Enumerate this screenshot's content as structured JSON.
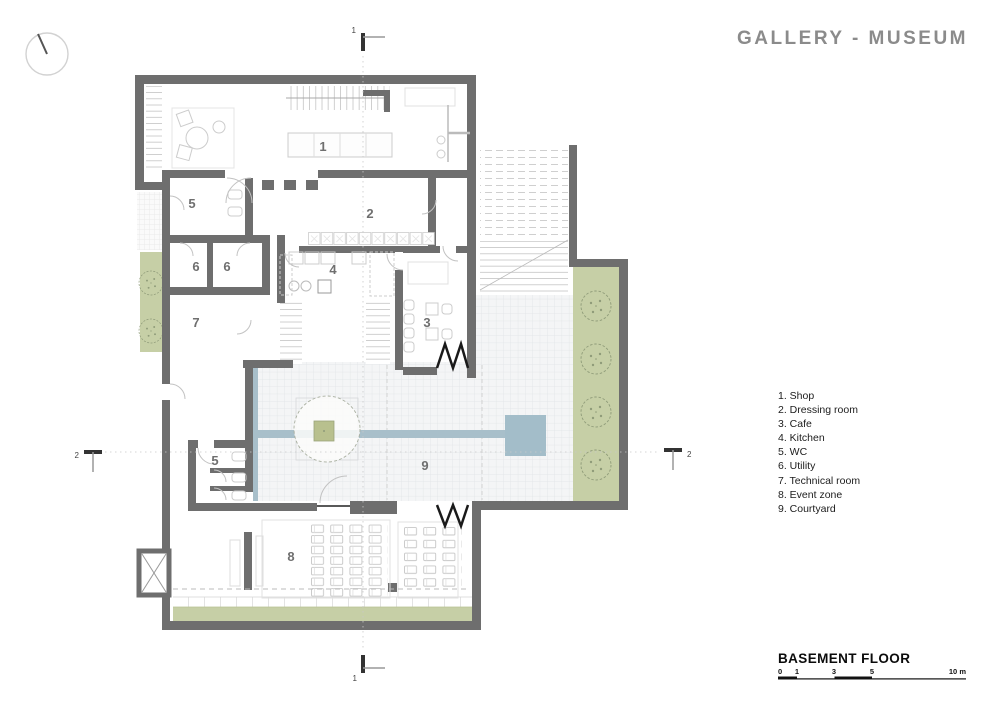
{
  "title": "GALLERY - MUSEUM",
  "floor": {
    "label": "BASEMENT FLOOR"
  },
  "legend": {
    "items": [
      "1. Shop",
      "2. Dressing room",
      "3. Cafe",
      "4. Kitchen",
      "5. WC",
      "6. Utility",
      "7. Technical room",
      "8. Event zone",
      "9. Courtyard"
    ]
  },
  "rooms": [
    {
      "num": "1",
      "name": "Shop"
    },
    {
      "num": "2",
      "name": "Dressing room"
    },
    {
      "num": "3",
      "name": "Cafe"
    },
    {
      "num": "4",
      "name": "Kitchen"
    },
    {
      "num": "5",
      "name": "WC"
    },
    {
      "num": "6",
      "name": "Utility"
    },
    {
      "num": "7",
      "name": "Technical room"
    },
    {
      "num": "8",
      "name": "Event zone"
    },
    {
      "num": "9",
      "name": "Courtyard"
    }
  ],
  "scale_bar": {
    "marks": [
      "0",
      "1",
      "3",
      "5",
      "10 m"
    ]
  },
  "section_markers": {
    "top": "1",
    "bottom": "1",
    "left": "2",
    "right": "2"
  },
  "colors": {
    "wall": "#6e6e6e",
    "greenery": "#c6cfa6",
    "water_channel": "#a8bfca",
    "pool": "#a3bdc9",
    "tile_floor": "#f4f5f6",
    "title_text": "#8b8b8b"
  }
}
